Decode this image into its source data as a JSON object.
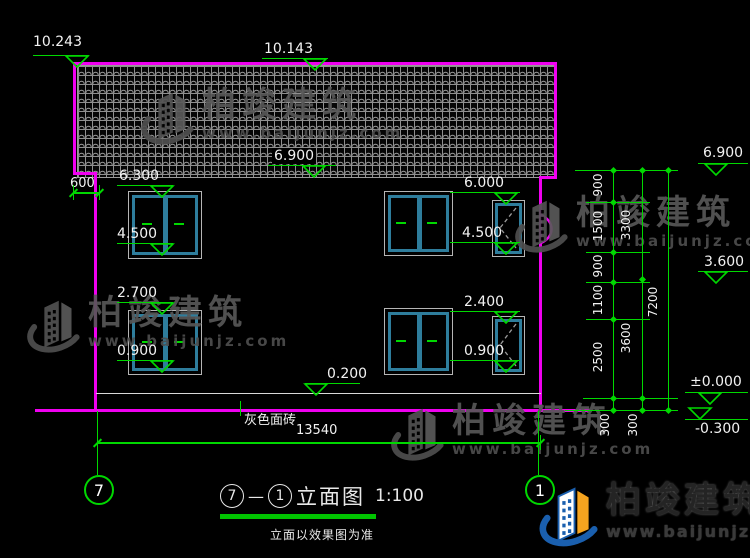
{
  "colors": {
    "green": "#00d800",
    "magenta": "#f000f0",
    "white": "#f2f2f2",
    "window_teal": "#2e7d9c",
    "tile_gray": "#8f8f8f",
    "watermark_gray": "#575757",
    "logo_blue": "#1a5fae",
    "logo_orange": "#f5a41f"
  },
  "watermark": {
    "brand": "柏竣建筑",
    "url": "www.baijunjz.com"
  },
  "title_block": {
    "axis_from": "7",
    "axis_to": "1",
    "dash": "—",
    "name": "立面图",
    "scale": "1:100",
    "note": "立面以效果图为准"
  },
  "material_label": {
    "text": "灰色面砖",
    "x": 244,
    "y": 414,
    "leader_x": 240,
    "leader_y1": 401,
    "leader_y2": 416
  },
  "elevation_markers": [
    {
      "text": "10.243",
      "tx": 33,
      "ty": 35,
      "lx": 33,
      "ly": 55,
      "lw": 56,
      "trix": 77,
      "triy": 55
    },
    {
      "text": "10.143",
      "tx": 264,
      "ty": 42,
      "lx": 262,
      "ly": 58,
      "lw": 66,
      "trix": 315,
      "triy": 58
    },
    {
      "text": "6.900",
      "tx": 272,
      "ty": 148,
      "lx": 268,
      "ly": 165,
      "lw": 68,
      "trix": 314,
      "triy": 165,
      "bg": true
    },
    {
      "text": "6.300",
      "tx": 119,
      "ty": 169,
      "lx": 117,
      "ly": 185,
      "lw": 56,
      "trix": 162,
      "triy": 185
    },
    {
      "text": "4.500",
      "tx": 117,
      "ty": 227,
      "lx": 117,
      "ly": 243,
      "lw": 56,
      "trix": 162,
      "triy": 243
    },
    {
      "text": "2.700",
      "tx": 117,
      "ty": 286,
      "lx": 117,
      "ly": 302,
      "lw": 56,
      "trix": 162,
      "triy": 302
    },
    {
      "text": "0.900",
      "tx": 117,
      "ty": 344,
      "lx": 117,
      "ly": 360,
      "lw": 56,
      "trix": 162,
      "triy": 360
    },
    {
      "text": "6.000",
      "tx": 464,
      "ty": 176,
      "lx": 450,
      "ly": 192,
      "lw": 70,
      "trix": 506,
      "triy": 192
    },
    {
      "text": "4.500",
      "tx": 462,
      "ty": 226,
      "lx": 450,
      "ly": 242,
      "lw": 70,
      "trix": 506,
      "triy": 242
    },
    {
      "text": "2.400",
      "tx": 464,
      "ty": 295,
      "lx": 450,
      "ly": 311,
      "lw": 70,
      "trix": 506,
      "triy": 311
    },
    {
      "text": "0.900",
      "tx": 464,
      "ty": 344,
      "lx": 450,
      "ly": 360,
      "lw": 70,
      "trix": 506,
      "triy": 360
    },
    {
      "text": "0.200",
      "tx": 327,
      "ty": 367,
      "lx": 305,
      "ly": 383,
      "lw": 55,
      "trix": 316,
      "triy": 383
    },
    {
      "text": "6.900",
      "tx": 703,
      "ty": 146,
      "lx": 698,
      "ly": 163,
      "lw": 50,
      "trix": 716,
      "triy": 163
    },
    {
      "text": "3.600",
      "tx": 704,
      "ty": 255,
      "lx": 698,
      "ly": 271,
      "lw": 50,
      "trix": 716,
      "triy": 271
    },
    {
      "text": "±0.000",
      "tx": 690,
      "ty": 375,
      "lx": 685,
      "ly": 392,
      "lw": 63,
      "trix": 710,
      "triy": 392
    },
    {
      "text": "-0.300",
      "tx": 695,
      "ty": 422,
      "lx": 685,
      "ly": 419,
      "lw": 63,
      "trix": 700,
      "triy": 407,
      "above": true
    }
  ],
  "h_dims": [
    {
      "text": "600",
      "tx": 70,
      "ty": 177,
      "lx": 73,
      "ly": 192,
      "lw": 26
    },
    {
      "text": "13540",
      "tx": 296,
      "ty": 424,
      "lx": 97,
      "ly": 442,
      "lw": 443
    }
  ],
  "v_dim_labels": [
    {
      "text": "900",
      "cx": 606,
      "cy": 186
    },
    {
      "text": "1500",
      "cx": 606,
      "cy": 227
    },
    {
      "text": "900",
      "cx": 606,
      "cy": 267
    },
    {
      "text": "1100",
      "cx": 606,
      "cy": 301
    },
    {
      "text": "2500",
      "cx": 606,
      "cy": 358
    },
    {
      "text": "300",
      "cx": 613,
      "cy": 426
    },
    {
      "text": "300",
      "cx": 641,
      "cy": 426
    },
    {
      "text": "3300",
      "cx": 634,
      "cy": 226
    },
    {
      "text": "3600",
      "cx": 634,
      "cy": 339
    },
    {
      "text": "7200",
      "cx": 661,
      "cy": 303
    }
  ],
  "v_chains": [
    {
      "x": 613,
      "ticks": [
        170,
        202,
        252,
        282,
        319,
        398,
        410
      ]
    },
    {
      "x": 642,
      "ticks": [
        170,
        279,
        398,
        410
      ]
    },
    {
      "x": 668,
      "ticks": [
        170,
        410
      ]
    }
  ],
  "ext_lines": [
    {
      "x": 575,
      "y": 170,
      "w": 103
    },
    {
      "x": 586,
      "y": 202,
      "w": 64
    },
    {
      "x": 586,
      "y": 252,
      "w": 64
    },
    {
      "x": 586,
      "y": 282,
      "w": 64
    },
    {
      "x": 586,
      "y": 319,
      "w": 64
    },
    {
      "x": 583,
      "y": 398,
      "w": 95
    },
    {
      "x": 565,
      "y": 410,
      "w": 113
    }
  ],
  "axis_bubbles": [
    {
      "label": "7",
      "cx": 97,
      "cy": 488
    },
    {
      "label": "1",
      "cx": 538,
      "cy": 488
    }
  ],
  "axis_lines": [
    {
      "x": 97,
      "y1": 411,
      "y2": 475
    },
    {
      "x": 538,
      "y1": 411,
      "y2": 475
    }
  ],
  "watermarks": [
    {
      "x": 138,
      "y": 88
    },
    {
      "x": 24,
      "y": 296
    },
    {
      "x": 512,
      "y": 196
    },
    {
      "x": 388,
      "y": 404
    }
  ]
}
